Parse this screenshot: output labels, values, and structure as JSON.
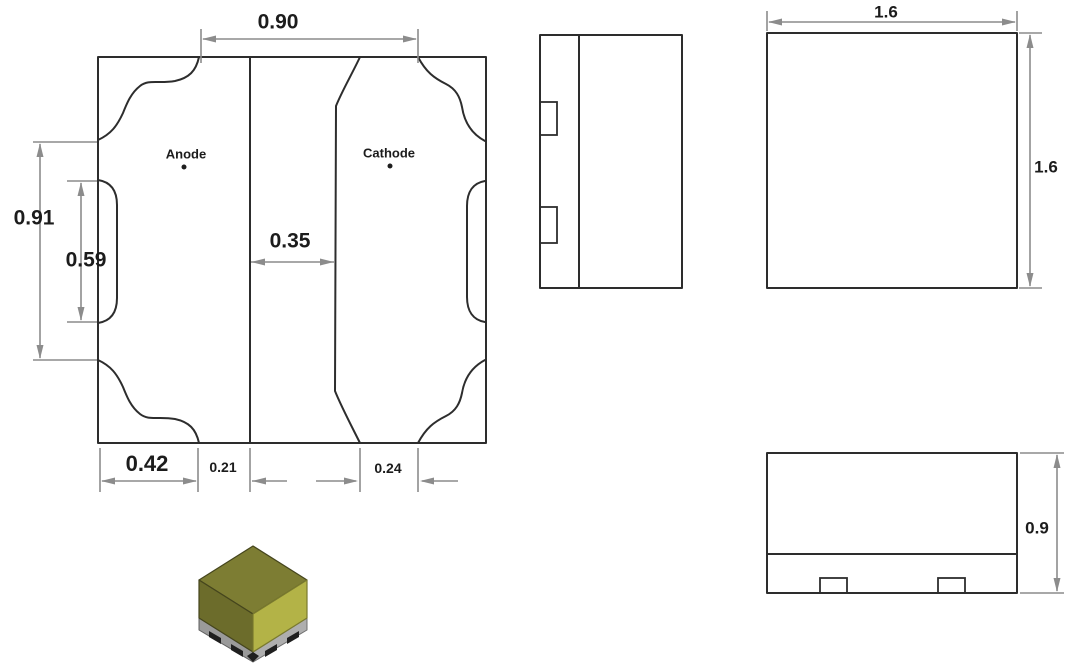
{
  "drawing": {
    "footprint": {
      "anode_label": "Anode",
      "cathode_label": "Cathode",
      "dim_top_width": "0.90",
      "dim_outer_height": "0.91",
      "dim_notch_height": "0.59",
      "dim_pad_gap": "0.35",
      "dim_anode_pad_width": "0.42",
      "dim_anode_gap": "0.21",
      "dim_cathode_inset": "0.24"
    },
    "top_view": {
      "dim_width": "1.6",
      "dim_height": "1.6"
    },
    "front_view": {
      "dim_height": "0.9"
    },
    "package_3d": {
      "top_color": "#7d7d33",
      "left_color": "#6c6c2b",
      "right_color": "#b3b347",
      "base_left_color": "#9a9a9a",
      "base_right_color": "#aeaeae",
      "base_edge_color": "#5f5f5f",
      "contact_color": "#1f1f1f",
      "face_edge_color": "#45451d"
    }
  }
}
